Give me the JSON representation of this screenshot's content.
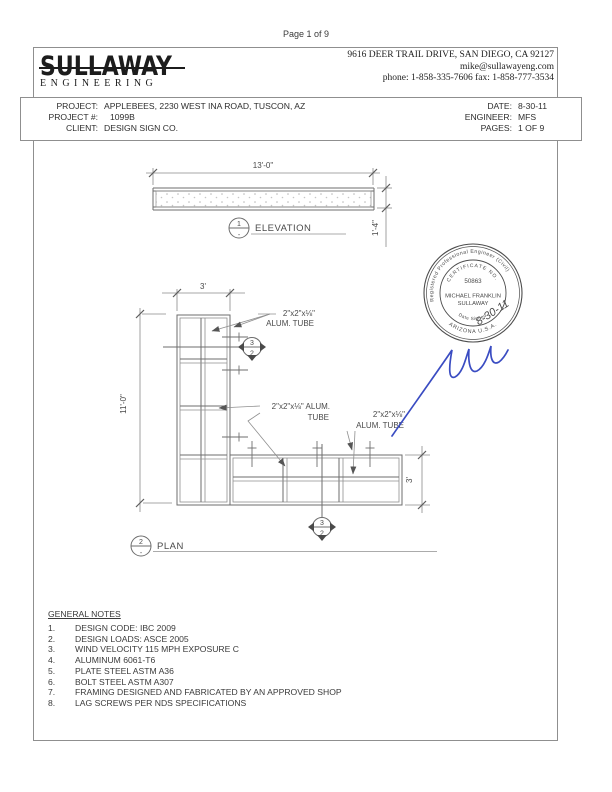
{
  "page_label": "Page 1 of 9",
  "letterhead": {
    "logo_title": "SULLAWAY",
    "logo_subtitle": "ENGINEERING",
    "address_line1": "9616 DEER TRAIL DRIVE, SAN DIEGO, CA 92127",
    "address_line2": "mike@sullawayeng.com",
    "address_line3": "phone: 1-858-335-7606  fax: 1-858-777-3534"
  },
  "project_info": {
    "project_label": "PROJECT:",
    "project_value": "APPLEBEES, 2230 WEST INA ROAD, TUSCON, AZ",
    "project_no_label": "PROJECT #:",
    "project_no_value": "1099B",
    "client_label": "CLIENT:",
    "client_value": "DESIGN SIGN CO.",
    "date_label": "DATE:",
    "date_value": "8-30-11",
    "engineer_label": "ENGINEER:",
    "engineer_value": "MFS",
    "pages_label": "PAGES:",
    "pages_value": "1 OF 9"
  },
  "elevation": {
    "width_dim": "13'-0\"",
    "height_dim": "1'-4\"",
    "marker_number": "1",
    "marker_sub": "-",
    "title": "ELEVATION"
  },
  "plan": {
    "top_dim": "3'",
    "left_dim": "11'-0\"",
    "right_dim": "3'",
    "marker_number": "2",
    "marker_sub": "-",
    "title": "PLAN",
    "section_marker_top": "3",
    "section_marker_bottom": "2",
    "label1_line1": "2\"x2\"x⅛\"",
    "label1_line2": "ALUM. TUBE",
    "label2_line1": "2\"x2\"x⅛\" ALUM.",
    "label2_line2": "TUBE",
    "label3_line1": "2\"x2\"x⅛\"",
    "label3_line2": "ALUM. TUBE"
  },
  "stamp": {
    "ring_text_top": "Registered Professional Engineer (Civil)",
    "ring_text_bottom": "ARIZONA U.S.A.",
    "cert_label": "CERTIFICATE NO.",
    "cert_number": "50863",
    "name_line1": "MICHAEL FRANKLIN",
    "name_line2": "SULLAWAY",
    "date_signed_label": "Date Signed",
    "signed_date": "8-30-11",
    "ink_color": "#3a4cc2"
  },
  "general_notes": {
    "title": "GENERAL NOTES",
    "items": [
      "DESIGN CODE: IBC 2009",
      "DESIGN LOADS: ASCE 2005",
      "WIND VELOCITY 115 MPH EXPOSURE C",
      "ALUMINUM 6061-T6",
      "PLATE STEEL ASTM A36",
      "BOLT STEEL ASTM A307",
      "FRAMING DESIGNED AND FABRICATED BY AN APPROVED SHOP",
      "LAG SCREWS PER NDS SPECIFICATIONS"
    ]
  }
}
